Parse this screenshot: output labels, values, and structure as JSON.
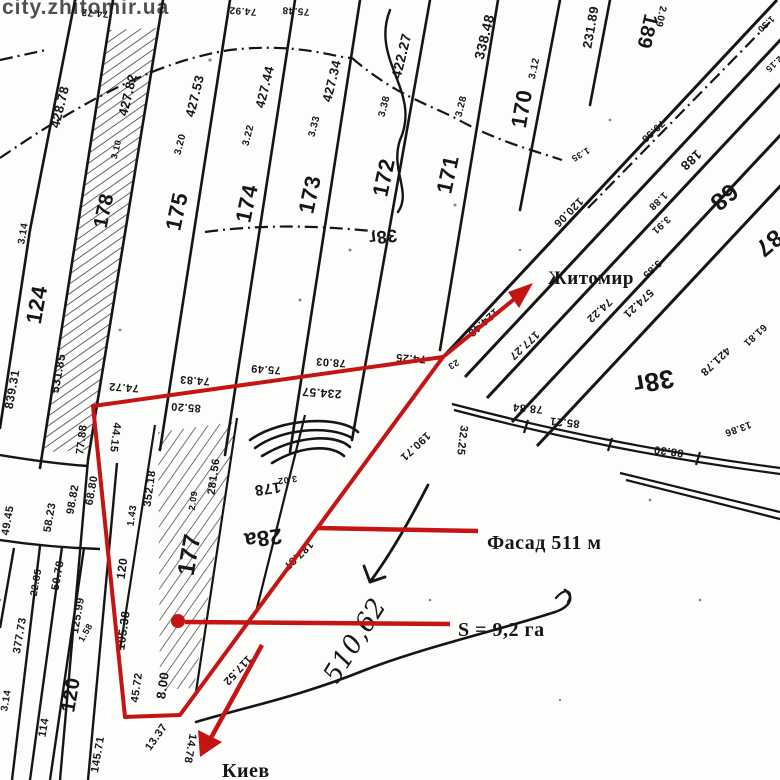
{
  "watermark": {
    "text": "city.zhitomir.ua",
    "color": "#eda678"
  },
  "annotations": {
    "color": "#c41414",
    "direction_ne": "Житомир",
    "direction_s": "Киев",
    "facade": "Фасад 511 м",
    "area": "S = 9,2 га"
  },
  "plot": {
    "boundary_color": "#c41414",
    "facade_length_m": 511,
    "area_ha": "9,2"
  },
  "map": {
    "labels": [
      {
        "t": "74.72",
        "x": 95,
        "y": 10,
        "r": 184,
        "s": 10
      },
      {
        "t": "74.92",
        "x": 243,
        "y": 8,
        "r": 184,
        "s": 10
      },
      {
        "t": "75.48",
        "x": 296,
        "y": 8,
        "r": 184,
        "s": 10
      },
      {
        "t": "428.78",
        "x": 64,
        "y": 108,
        "r": -76,
        "s": 13
      },
      {
        "t": "427.82",
        "x": 132,
        "y": 96,
        "r": -76,
        "s": 13
      },
      {
        "t": "3.10",
        "x": 119,
        "y": 150,
        "r": -76,
        "s": 9
      },
      {
        "t": "178",
        "x": 110,
        "y": 212,
        "r": -78,
        "s": 20
      },
      {
        "t": "427.53",
        "x": 199,
        "y": 97,
        "r": -76,
        "s": 13
      },
      {
        "t": "3.20",
        "x": 183,
        "y": 145,
        "r": -76,
        "s": 10
      },
      {
        "t": "175",
        "x": 184,
        "y": 213,
        "r": -78,
        "s": 22
      },
      {
        "t": "427.44",
        "x": 269,
        "y": 88,
        "r": -76,
        "s": 13
      },
      {
        "t": "3.22",
        "x": 251,
        "y": 136,
        "r": -76,
        "s": 10
      },
      {
        "t": "174",
        "x": 254,
        "y": 205,
        "r": -78,
        "s": 22
      },
      {
        "t": "427.34",
        "x": 336,
        "y": 82,
        "r": -76,
        "s": 13
      },
      {
        "t": "3.33",
        "x": 317,
        "y": 127,
        "r": -76,
        "s": 10
      },
      {
        "t": "173",
        "x": 317,
        "y": 196,
        "r": -78,
        "s": 22
      },
      {
        "t": "422.27",
        "x": 406,
        "y": 57,
        "r": -76,
        "s": 14
      },
      {
        "t": "3.38",
        "x": 387,
        "y": 107,
        "r": -76,
        "s": 10
      },
      {
        "t": "172",
        "x": 391,
        "y": 179,
        "r": -78,
        "s": 22
      },
      {
        "t": "38г",
        "x": 382,
        "y": 231,
        "r": 173,
        "s": 18
      },
      {
        "t": "338.48",
        "x": 489,
        "y": 38,
        "r": -76,
        "s": 14
      },
      {
        "t": "3.28",
        "x": 464,
        "y": 107,
        "r": -76,
        "s": 10
      },
      {
        "t": "171",
        "x": 455,
        "y": 176,
        "r": -78,
        "s": 22
      },
      {
        "t": "3.12",
        "x": 537,
        "y": 69,
        "r": -78,
        "s": 10
      },
      {
        "t": "170",
        "x": 529,
        "y": 110,
        "r": -80,
        "s": 22
      },
      {
        "t": "231.89",
        "x": 595,
        "y": 28,
        "r": -80,
        "s": 13
      },
      {
        "t": "189",
        "x": 641,
        "y": 30,
        "r": 103,
        "s": 20
      },
      {
        "t": "2.09",
        "x": 658,
        "y": 16,
        "r": 103,
        "s": 10
      },
      {
        "t": "124",
        "x": 44,
        "y": 306,
        "r": -80,
        "s": 22
      },
      {
        "t": "3.14",
        "x": 26,
        "y": 234,
        "r": -80,
        "s": 10
      },
      {
        "t": "839.31",
        "x": 16,
        "y": 390,
        "r": -80,
        "s": 12
      },
      {
        "t": "531.85",
        "x": 62,
        "y": 374,
        "r": -80,
        "s": 12
      },
      {
        "t": "1.35",
        "x": 579,
        "y": 152,
        "r": 150,
        "s": 9
      },
      {
        "t": "120.06",
        "x": 566,
        "y": 210,
        "r": 135,
        "s": 11
      },
      {
        "t": "79.38",
        "x": 651,
        "y": 129,
        "r": 137,
        "s": 10
      },
      {
        "t": "1.30",
        "x": 764,
        "y": 22,
        "r": 137,
        "s": 9
      },
      {
        "t": "2.15",
        "x": 772,
        "y": 62,
        "r": 137,
        "s": 9
      },
      {
        "t": "188",
        "x": 688,
        "y": 157,
        "r": 137,
        "s": 13
      },
      {
        "t": "1.88",
        "x": 656,
        "y": 199,
        "r": 137,
        "s": 10
      },
      {
        "t": "3.91",
        "x": 659,
        "y": 223,
        "r": 137,
        "s": 10
      },
      {
        "t": "3.85",
        "x": 650,
        "y": 267,
        "r": 137,
        "s": 10
      },
      {
        "t": "574.21",
        "x": 636,
        "y": 301,
        "r": 137,
        "s": 11
      },
      {
        "t": "68",
        "x": 719,
        "y": 191,
        "r": 140,
        "s": 24
      },
      {
        "t": "87",
        "x": 764,
        "y": 237,
        "r": 140,
        "s": 24
      },
      {
        "t": "38г",
        "x": 652,
        "y": 373,
        "r": 170,
        "s": 26
      },
      {
        "t": "421.78",
        "x": 713,
        "y": 359,
        "r": 137,
        "s": 11
      },
      {
        "t": "61.81",
        "x": 753,
        "y": 333,
        "r": 137,
        "s": 10
      },
      {
        "t": "13.86",
        "x": 737,
        "y": 426,
        "r": 160,
        "s": 10
      },
      {
        "t": "74.22",
        "x": 597,
        "y": 308,
        "r": 137,
        "s": 11
      },
      {
        "t": "177.27",
        "x": 522,
        "y": 343,
        "r": 137,
        "s": 11
      },
      {
        "t": "124.48",
        "x": 481,
        "y": 320,
        "r": 138,
        "s": 11
      },
      {
        "t": "78.84",
        "x": 528,
        "y": 405,
        "r": 185,
        "s": 11
      },
      {
        "t": "85.21",
        "x": 565,
        "y": 419,
        "r": 186,
        "s": 11
      },
      {
        "t": "88.30",
        "x": 669,
        "y": 448,
        "r": 188,
        "s": 11
      },
      {
        "t": "74.25",
        "x": 411,
        "y": 355,
        "r": 184,
        "s": 11
      },
      {
        "t": "23",
        "x": 452,
        "y": 362,
        "r": 150,
        "s": 9
      },
      {
        "t": "32.25",
        "x": 459,
        "y": 440,
        "r": 97,
        "s": 11
      },
      {
        "t": "190.71",
        "x": 413,
        "y": 444,
        "r": 137,
        "s": 11
      },
      {
        "t": "78.03",
        "x": 331,
        "y": 359,
        "r": 184,
        "s": 11
      },
      {
        "t": "75.49",
        "x": 266,
        "y": 366,
        "r": 184,
        "s": 11
      },
      {
        "t": "74.83",
        "x": 195,
        "y": 377,
        "r": 184,
        "s": 11
      },
      {
        "t": "74.72",
        "x": 124,
        "y": 384,
        "r": 184,
        "s": 11
      },
      {
        "t": "234.57",
        "x": 322,
        "y": 389,
        "r": 184,
        "s": 12
      },
      {
        "t": "85.20",
        "x": 186,
        "y": 404,
        "r": 184,
        "s": 11
      },
      {
        "t": "44.15",
        "x": 112,
        "y": 437,
        "r": 97,
        "s": 11
      },
      {
        "t": "77.88",
        "x": 85,
        "y": 440,
        "r": -83,
        "s": 11
      },
      {
        "t": "187.87",
        "x": 296,
        "y": 553,
        "r": 136,
        "s": 11
      },
      {
        "t": "117.52",
        "x": 235,
        "y": 668,
        "r": 133,
        "s": 11
      },
      {
        "t": "352.18",
        "x": 153,
        "y": 489,
        "r": -82,
        "s": 11
      },
      {
        "t": "2.09",
        "x": 196,
        "y": 501,
        "r": -82,
        "s": 9
      },
      {
        "t": "281.56",
        "x": 217,
        "y": 477,
        "r": -82,
        "s": 11
      },
      {
        "t": "177",
        "x": 197,
        "y": 556,
        "r": -80,
        "s": 24
      },
      {
        "t": "28а",
        "x": 262,
        "y": 531,
        "r": 172,
        "s": 22
      },
      {
        "t": "178",
        "x": 267,
        "y": 484,
        "r": 172,
        "s": 15
      },
      {
        "t": "3.02",
        "x": 287,
        "y": 477,
        "r": 172,
        "s": 9
      },
      {
        "t": "1.43",
        "x": 135,
        "y": 516,
        "r": -82,
        "s": 10
      },
      {
        "t": "120",
        "x": 126,
        "y": 569,
        "r": -82,
        "s": 12
      },
      {
        "t": "105.38",
        "x": 127,
        "y": 631,
        "r": -82,
        "s": 12
      },
      {
        "t": "45.72",
        "x": 140,
        "y": 688,
        "r": -82,
        "s": 11
      },
      {
        "t": "8.00",
        "x": 167,
        "y": 686,
        "r": -82,
        "s": 13
      },
      {
        "t": "13.37",
        "x": 159,
        "y": 739,
        "r": -55,
        "s": 11
      },
      {
        "t": "14.78",
        "x": 187,
        "y": 748,
        "r": 100,
        "s": 11
      },
      {
        "t": "49.45",
        "x": 11,
        "y": 521,
        "r": -80,
        "s": 11
      },
      {
        "t": "58.23",
        "x": 53,
        "y": 518,
        "r": -80,
        "s": 11
      },
      {
        "t": "98.82",
        "x": 76,
        "y": 500,
        "r": -80,
        "s": 11
      },
      {
        "t": "68.80",
        "x": 95,
        "y": 491,
        "r": -80,
        "s": 11
      },
      {
        "t": "22.85",
        "x": 39,
        "y": 583,
        "r": -80,
        "s": 10
      },
      {
        "t": "50.78",
        "x": 61,
        "y": 576,
        "r": -80,
        "s": 11
      },
      {
        "t": "125.99",
        "x": 81,
        "y": 616,
        "r": -80,
        "s": 11
      },
      {
        "t": "1.58",
        "x": 88,
        "y": 634,
        "r": -60,
        "s": 9
      },
      {
        "t": "377.73",
        "x": 23,
        "y": 636,
        "r": -80,
        "s": 11
      },
      {
        "t": "3.14",
        "x": 9,
        "y": 701,
        "r": -80,
        "s": 10
      },
      {
        "t": "114",
        "x": 47,
        "y": 728,
        "r": -80,
        "s": 11
      },
      {
        "t": "120",
        "x": 77,
        "y": 696,
        "r": -80,
        "s": 20
      },
      {
        "t": "145.71",
        "x": 101,
        "y": 755,
        "r": -80,
        "s": 11
      },
      {
        "t": "510,62",
        "x": 362,
        "y": 645,
        "r": -58,
        "s": 26,
        "c": "hand"
      }
    ]
  }
}
